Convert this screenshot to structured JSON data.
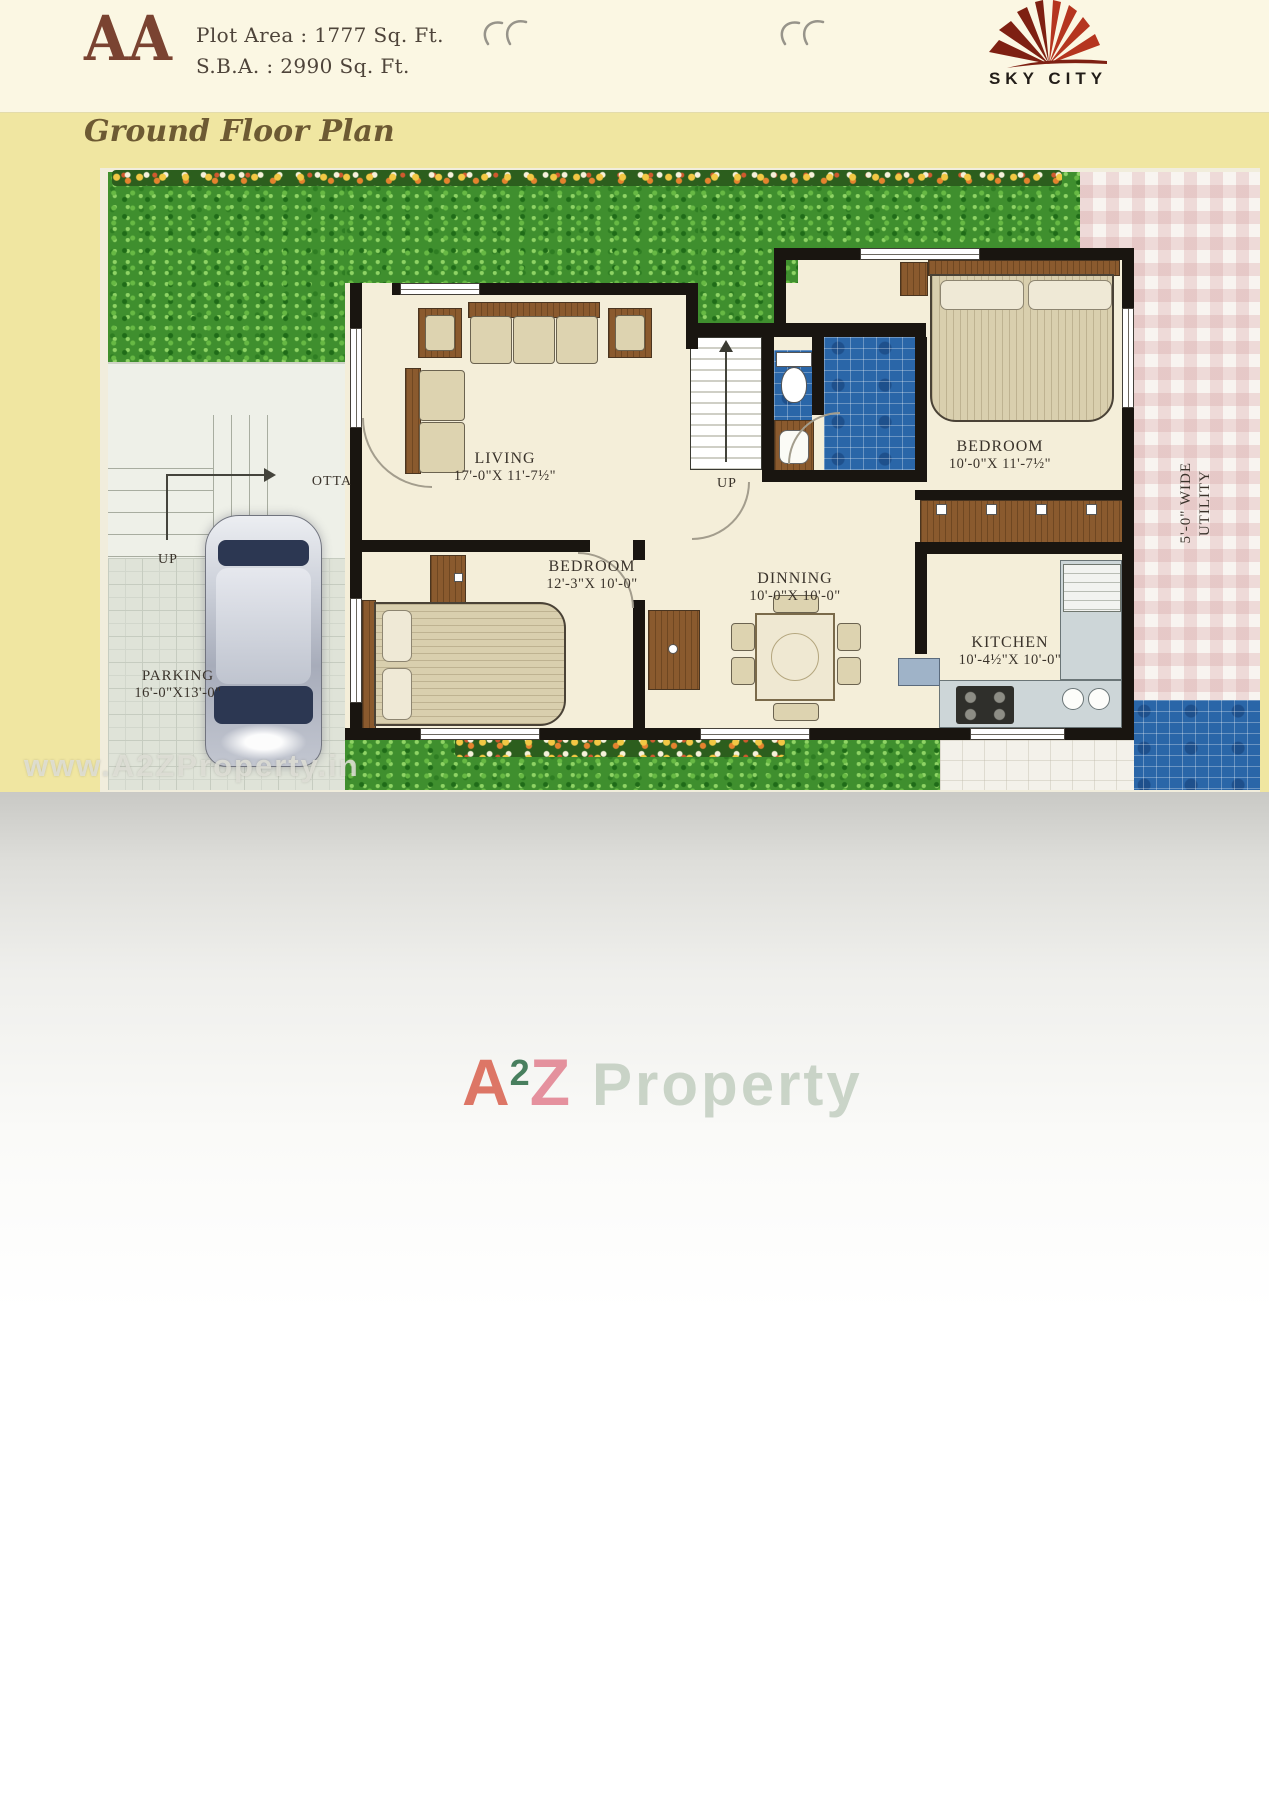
{
  "page": {
    "header": {
      "section_code": "AA",
      "plot_area": "Plot Area : 1777 Sq. Ft.",
      "sba": "S.B.A. : 2990 Sq. Ft.",
      "brand": "SKY CITY"
    },
    "title": "Ground Floor Plan"
  },
  "plan": {
    "rooms": {
      "living": {
        "name": "LIVING",
        "dims": "17'-0\"X 11'-7½\""
      },
      "bedroom_left": {
        "name": "BEDROOM",
        "dims": "12'-3\"X 10'-0\""
      },
      "dinning": {
        "name": "DINNING",
        "dims": "10'-0\"X 10'-0\""
      },
      "bedroom_right": {
        "name": "BEDROOM",
        "dims": "10'-0\"X 11'-7½\""
      },
      "kitchen": {
        "name": "KITCHEN",
        "dims": "10'-4½\"X 10'-0\""
      },
      "parking": {
        "name": "PARKING",
        "dims": "16'-0\"X13'-0\""
      }
    },
    "labels": {
      "otta": "OTTA",
      "up_otta": "UP",
      "up_stairs": "UP",
      "utility_line1": "5'-0\" WIDE",
      "utility_line2": "UTILITY"
    }
  },
  "watermark": {
    "url": "www.A2ZProperty.in",
    "brand": {
      "a": "A",
      "two": "2",
      "z": "Z",
      "name": "Property"
    }
  },
  "colors": {
    "page_yellow": "#f0e6a1",
    "header_cream": "#fbf7e3",
    "accent_brown": "#7a4331",
    "title_brown": "#6d5a33",
    "label_ink": "#3a332b",
    "wall_black": "#191510",
    "floor_cream": "#f4eed9",
    "grass_green": "#3f8f2e",
    "tile_blue": "#2a66a8",
    "wood_brown": "#8a5a2e",
    "logo_red_dark": "#7e2012",
    "logo_red": "#b5351f",
    "watermark_gray": "#d7d7cf"
  }
}
